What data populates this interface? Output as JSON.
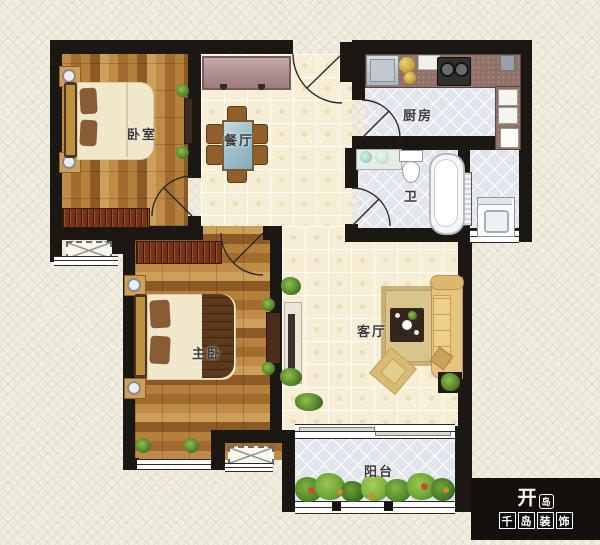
{
  "rooms": {
    "bedroom": "卧室",
    "dining": "餐厅",
    "kitchen": "厨房",
    "bath": "卫",
    "master_bedroom": "主卧",
    "living": "客厅",
    "balcony": "阳台"
  },
  "logo": {
    "mark_char": "开",
    "mark_badge_char": "岛",
    "brand_chars": [
      "千",
      "岛",
      "装",
      "饰"
    ]
  },
  "colors": {
    "wall": "#1b1712",
    "background": "#f1ede1",
    "wood_floor": "#b07a38",
    "cream_tile": "#f7eed6",
    "gray_tile": "#e2e5eb",
    "entry_cabinet": "#b18c8e",
    "sofa": "#e6c47f",
    "logo_background": "#14100d"
  }
}
